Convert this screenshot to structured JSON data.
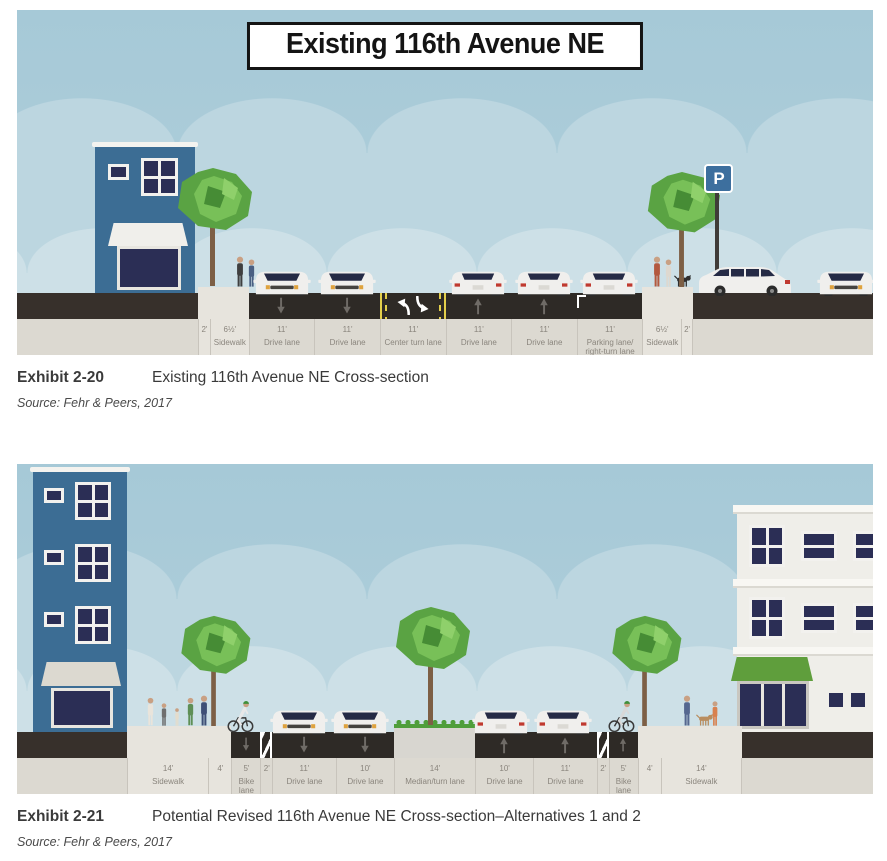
{
  "palette": {
    "sky": "#a8cad8",
    "cloud_upper": "#bcd6e0",
    "cloud_lower": "#cde0e7",
    "road": "#2e2a26",
    "ground": "#37302b",
    "sidewalk": "#e7e4dd",
    "measure_strip": "#dcd9d1",
    "label_text": "#8a857d",
    "building_blue": "#3c6d94",
    "building_cream": "#efeee9",
    "window_glass": "#2b2e55",
    "tree_green": "#5aa343",
    "median_grass": "#4f9e3b",
    "lane_yellow": "#e3cf4b",
    "arrow_gray": "#6f6b66",
    "car_body": "#f0efed",
    "sign_blue": "#3d6f9e",
    "awning_green": "#5f9e3c"
  },
  "exhibits": {
    "e20": {
      "banner": "Existing 116th Avenue NE",
      "caption_label": "Exhibit 2-20",
      "caption_title": "Existing 116th Avenue NE Cross-section",
      "source": "Source: Fehr & Peers, 2017",
      "parking_sign_letter": "P",
      "lanes": [
        {
          "width": "2'",
          "name": "",
          "ft": 2,
          "type": "sidewalk"
        },
        {
          "width": "6½'",
          "name": "Sidewalk",
          "ft": 6.5,
          "type": "sidewalk"
        },
        {
          "width": "11'",
          "name": "Drive lane",
          "ft": 11,
          "type": "drive-down"
        },
        {
          "width": "11'",
          "name": "Drive lane",
          "ft": 11,
          "type": "drive-down"
        },
        {
          "width": "11'",
          "name": "Center turn lane",
          "ft": 11,
          "type": "center-turn"
        },
        {
          "width": "11'",
          "name": "Drive lane",
          "ft": 11,
          "type": "drive-up"
        },
        {
          "width": "11'",
          "name": "Drive lane",
          "ft": 11,
          "type": "drive-up"
        },
        {
          "width": "11'",
          "name": "Parking lane/ right-turn lane",
          "ft": 11,
          "type": "parking"
        },
        {
          "width": "6½'",
          "name": "Sidewalk",
          "ft": 6.5,
          "type": "sidewalk"
        },
        {
          "width": "2'",
          "name": "",
          "ft": 2,
          "type": "sidewalk"
        }
      ]
    },
    "e21": {
      "caption_label": "Exhibit 2-21",
      "caption_title": "Potential Revised 116th Avenue NE Cross-section–Alternatives 1 and 2",
      "source": "Source: Fehr & Peers, 2017",
      "lanes": [
        {
          "width": "14'",
          "name": "Sidewalk",
          "ft": 14,
          "type": "sidewalk"
        },
        {
          "width": "4'",
          "name": "",
          "ft": 4,
          "type": "sidewalk"
        },
        {
          "width": "5'",
          "name": "Bike lane",
          "ft": 5,
          "type": "bike-down"
        },
        {
          "width": "2'",
          "name": "",
          "ft": 2,
          "type": "hatch"
        },
        {
          "width": "11'",
          "name": "Drive lane",
          "ft": 11,
          "type": "drive-down"
        },
        {
          "width": "10'",
          "name": "Drive lane",
          "ft": 10,
          "type": "drive-down"
        },
        {
          "width": "14'",
          "name": "Median/turn lane",
          "ft": 14,
          "type": "median"
        },
        {
          "width": "10'",
          "name": "Drive lane",
          "ft": 10,
          "type": "drive-up"
        },
        {
          "width": "11'",
          "name": "Drive lane",
          "ft": 11,
          "type": "drive-up"
        },
        {
          "width": "2'",
          "name": "",
          "ft": 2,
          "type": "hatch"
        },
        {
          "width": "5'",
          "name": "Bike lane",
          "ft": 5,
          "type": "bike-up"
        },
        {
          "width": "4'",
          "name": "",
          "ft": 4,
          "type": "sidewalk"
        },
        {
          "width": "14'",
          "name": "Sidewalk",
          "ft": 14,
          "type": "sidewalk"
        }
      ]
    }
  }
}
